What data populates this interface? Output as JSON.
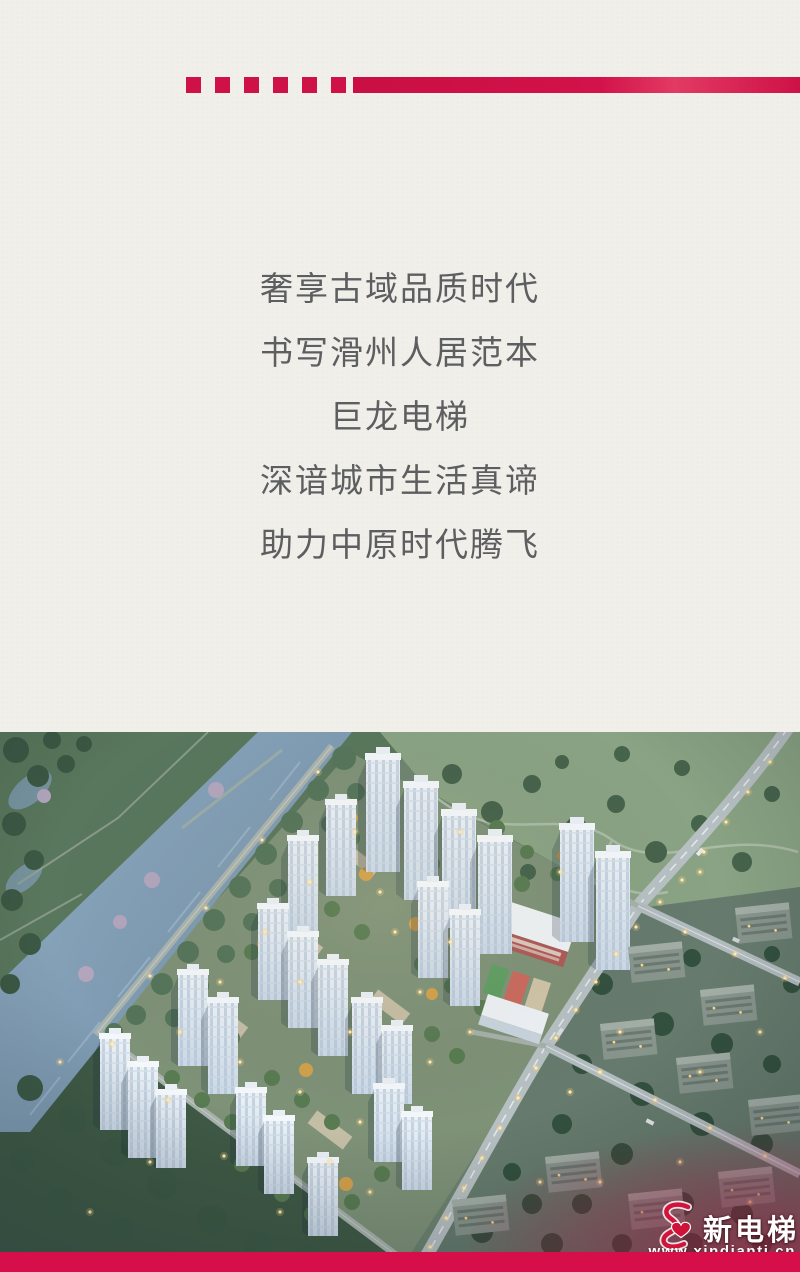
{
  "page": {
    "background_color": "#f1efea",
    "accent_color": "#ce1247"
  },
  "slogan": {
    "text_color": "#5d5e60",
    "lines": [
      "奢享古域品质时代",
      "书写滑州人居范本",
      "巨龙电梯",
      "深谙城市生活真谛",
      "助力中原时代腾飞"
    ]
  },
  "photo": {
    "label": "aerial-dusk-rendering-of-residential-complex"
  },
  "watermark": {
    "brand": "新电梯",
    "url": "www.xindianti.cn",
    "strip_color": "#d60f4b",
    "logo": "figure-8-ribbon-with-heart"
  }
}
